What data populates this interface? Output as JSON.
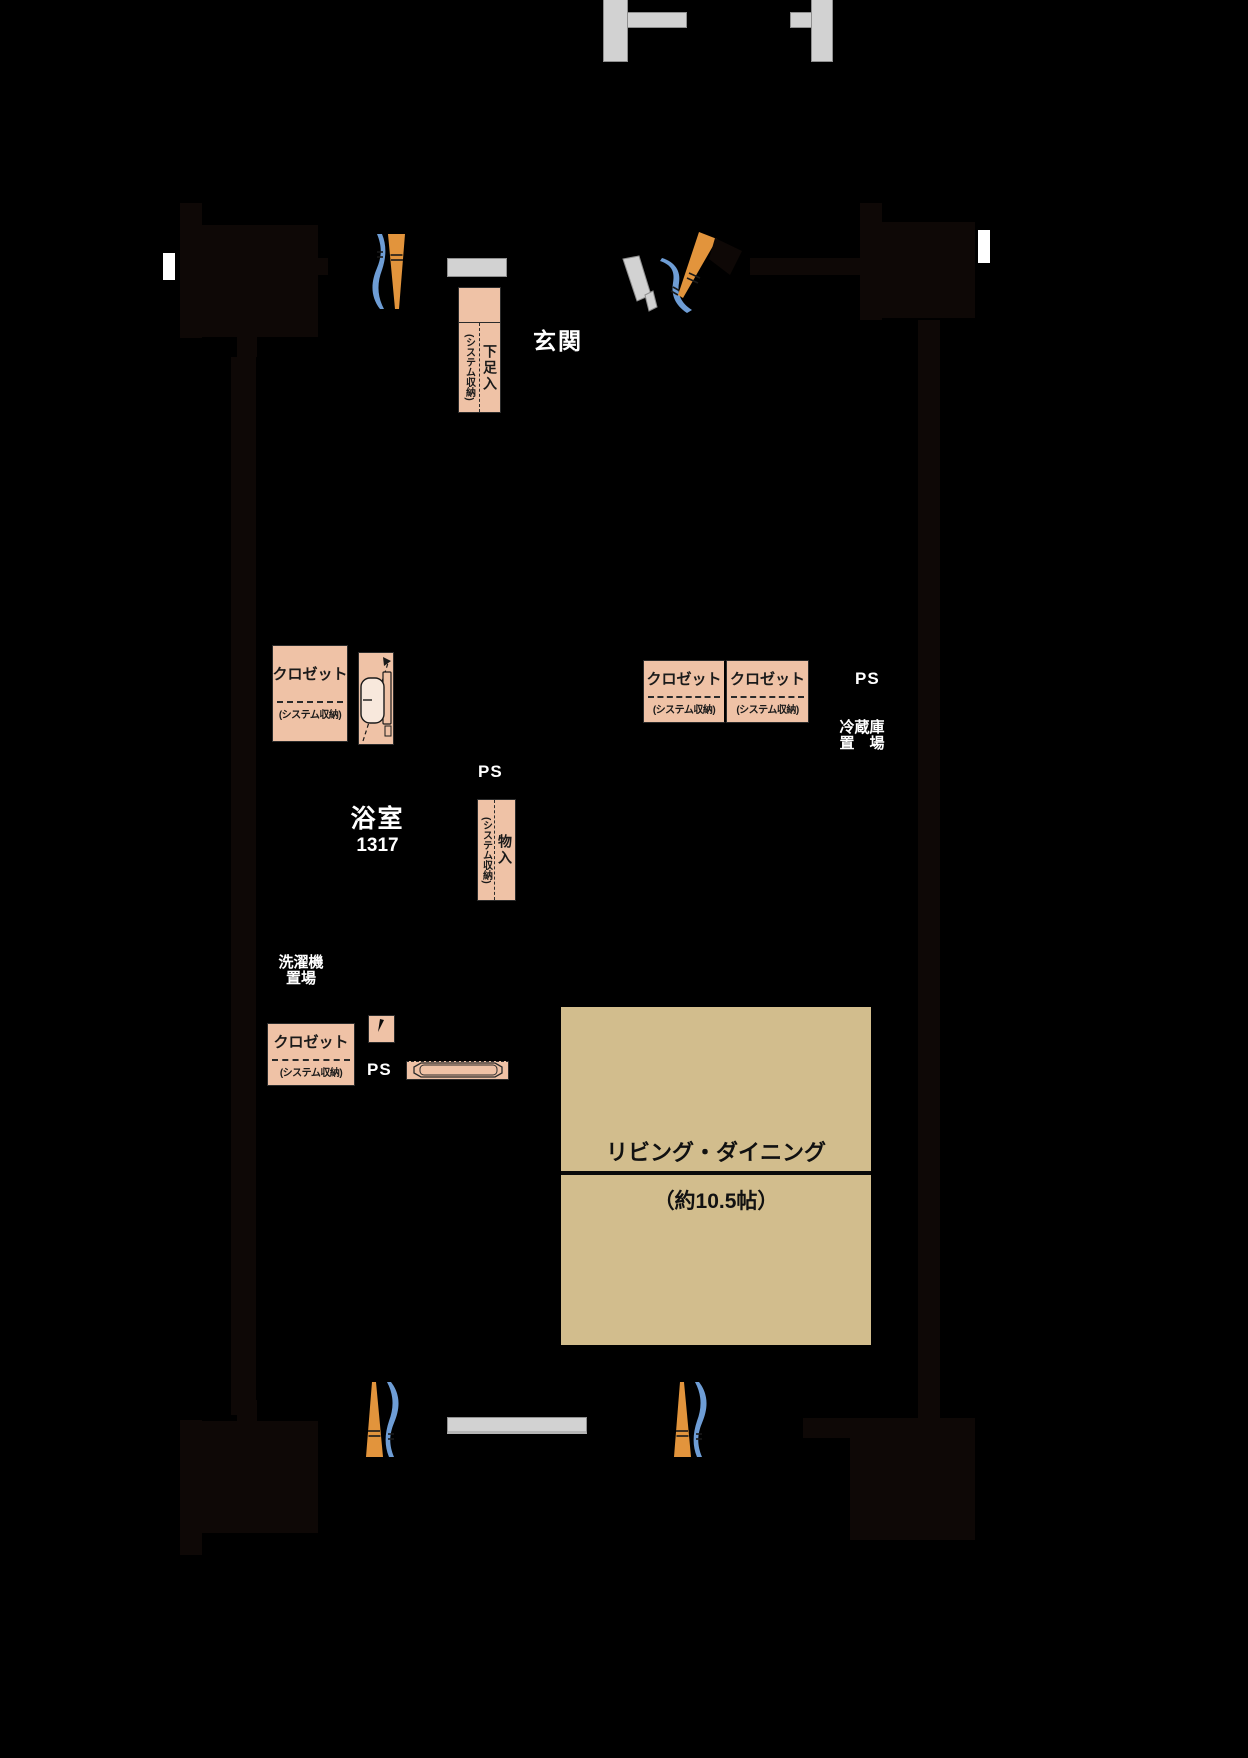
{
  "rooms": {
    "entrance": {
      "label": "玄関"
    },
    "bathroom": {
      "label": "浴室",
      "size": "1317"
    },
    "living_dining": {
      "label": "リビング・ダイニング",
      "size": "（約10.5帖）"
    }
  },
  "ps": {
    "hall": "PS",
    "kitchen": "PS",
    "right": "PS"
  },
  "areas": {
    "fridge": {
      "line1": "冷蔵庫",
      "line2": "置　場"
    },
    "laundry": {
      "line1": "洗濯機",
      "line2": "置場"
    }
  },
  "closets": {
    "hall": {
      "label": "クロゼット",
      "sub": "(システム収納)"
    },
    "center_left": {
      "label": "クロゼット",
      "sub": "(システム収納)"
    },
    "center_right": {
      "label": "クロゼット",
      "sub": "(システム収納)"
    },
    "lower": {
      "label": "クロゼット",
      "sub": "(システム収納)"
    }
  },
  "storage": {
    "shoe": {
      "label": "下足入",
      "sub": "(システム収納)"
    },
    "misc": {
      "label": "物入",
      "sub": "(システム収納)"
    }
  },
  "colors": {
    "background": "#000000",
    "storage_fill": "#efc2a6",
    "living_fill": "#d2bd8d",
    "concrete_gray": "#d2d2d2",
    "curtain_orange": "#e2943c",
    "curtain_blue": "#6e9dd5",
    "wall_dark": "#0e0806"
  }
}
